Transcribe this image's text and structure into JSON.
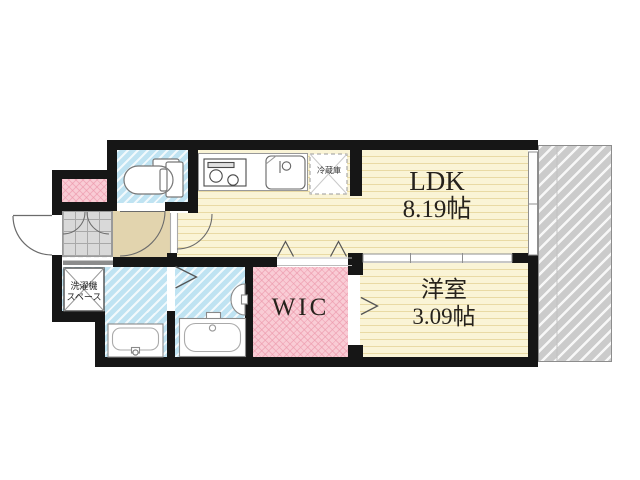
{
  "plan": {
    "type": "floor-plan-1K",
    "rooms": {
      "ldk": {
        "name": "LDK",
        "area": "8.19帖"
      },
      "western": {
        "name": "洋室",
        "area": "3.09帖"
      },
      "wic": {
        "name": "WIC"
      },
      "fridge": {
        "label": "冷蔵庫"
      },
      "laundry": {
        "line1": "洗濯機",
        "line2": "スペース"
      }
    },
    "colors": {
      "room_yellow": "#faf4d6",
      "room_cyan": "#bfe3f2",
      "room_pink": "#f9ccd5",
      "hall_beige": "#e2d4ae",
      "entry_tile": "#d9d9d9",
      "balcony_gray": "#cbcbcb",
      "wall": "#161616"
    }
  }
}
